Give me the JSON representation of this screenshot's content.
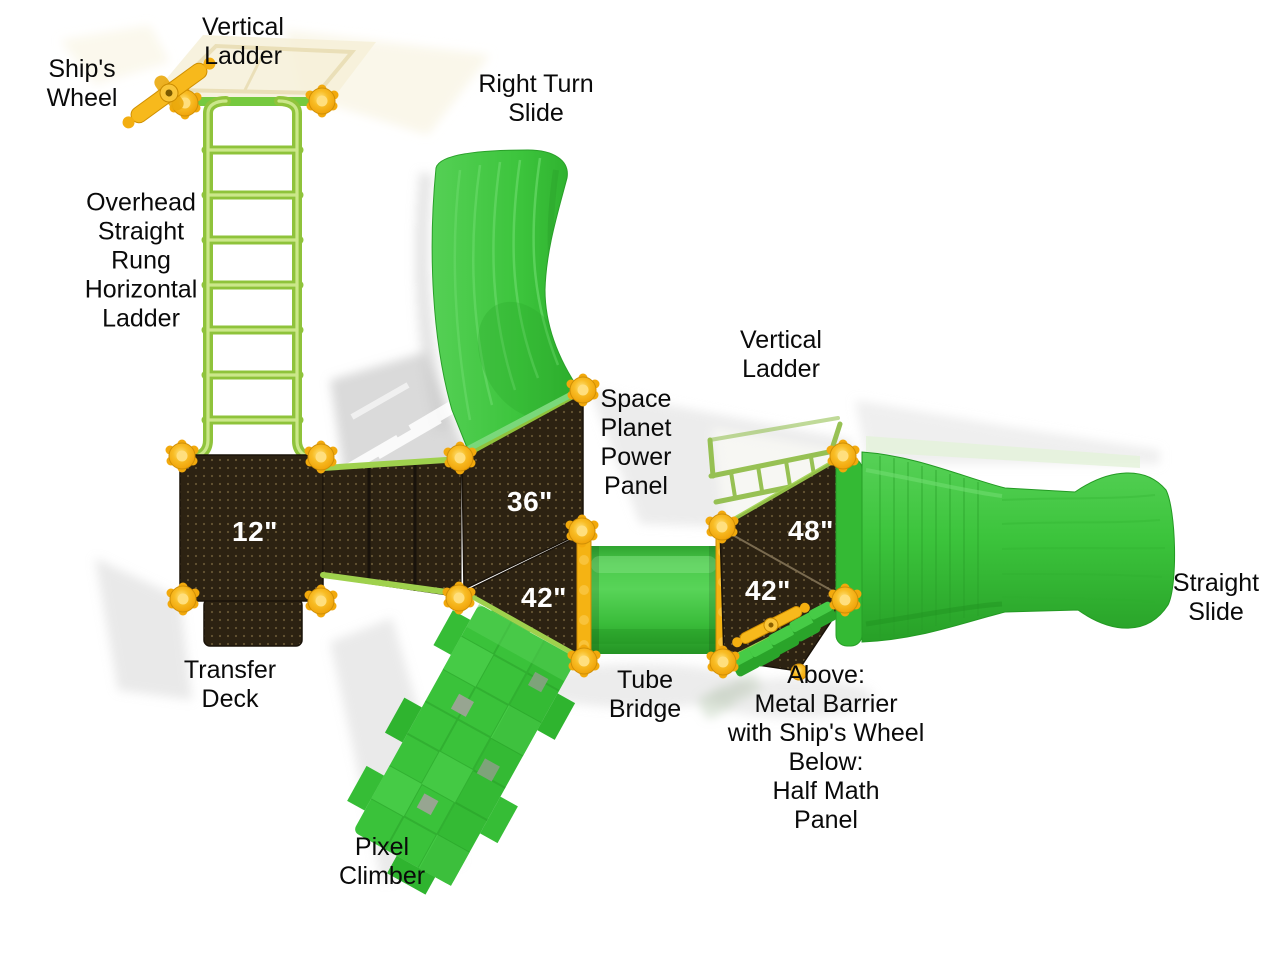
{
  "figure": {
    "kind": "playground-structure-top-view",
    "background": "#ffffff"
  },
  "colors": {
    "slide_green": "#3cc43c",
    "ladder_green": "#9fd14d",
    "deck_brown": "#2c2212",
    "post_yellow": "#f6b31a",
    "label_text": "#0a0a0a",
    "size_text": "#ffffff"
  },
  "labels": {
    "ships_wheel": "Ship's\nWheel",
    "vertical_ladder_top": "Vertical\nLadder",
    "overhead_ladder": "Overhead\nStraight\nRung\nHorizontal\nLadder",
    "right_turn_slide": "Right Turn\nSlide",
    "vertical_ladder_right": "Vertical\nLadder",
    "space_planet_power_panel": "Space\nPlanet\nPower\nPanel",
    "straight_slide": "Straight\nSlide",
    "transfer_deck": "Transfer\nDeck",
    "tube_bridge": "Tube\nBridge",
    "barrier_note": "Above:\nMetal Barrier\nwith Ship's Wheel\nBelow:\nHalf Math\nPanel",
    "pixel_climber": "Pixel\nClimber"
  },
  "deck_heights": {
    "deck_12": "12\"",
    "deck_36": "36\"",
    "deck_42_left": "42\"",
    "deck_48": "48\"",
    "deck_42_right": "42\""
  }
}
